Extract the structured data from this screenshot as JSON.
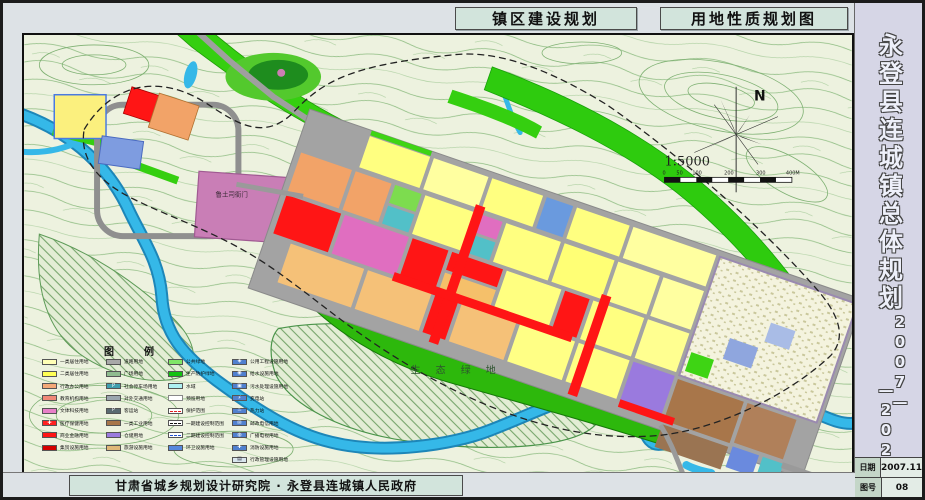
{
  "titles": {
    "left": "镇区建设规划",
    "right": "用地性质规划图"
  },
  "sidebar": {
    "title": "永登县连城镇总体规划",
    "years_top": "2007—",
    "years_bottom": "—2020",
    "table": [
      {
        "label": "日期",
        "value": "2007.11"
      },
      {
        "label": "图号",
        "value": "08"
      }
    ]
  },
  "footer": {
    "text": "甘肃省城乡规划设计研究院 · 永登县连城镇人民政府"
  },
  "map": {
    "labels": {
      "eco_green": "生 态 绿 地",
      "heritage": "鲁土司衙门"
    },
    "north_label": "N",
    "scale_text": "1:5000",
    "scale_ticks": [
      "0",
      "50",
      "100",
      "200",
      "300",
      "400M"
    ]
  },
  "legend": {
    "title": "图　例",
    "columns": [
      [
        {
          "label": "一类居住用地",
          "type": "solid",
          "color": "#ffffb6"
        },
        {
          "label": "二类居住用地",
          "type": "solid",
          "color": "#ffff55"
        },
        {
          "label": "行政办公用地",
          "type": "solid",
          "color": "#f4a978"
        },
        {
          "label": "教育机构用地",
          "type": "solid",
          "color": "#f08878"
        },
        {
          "label": "文体科技用地",
          "type": "solid",
          "color": "#e87fc8"
        },
        {
          "label": "医疗保健用地",
          "type": "cross",
          "color": "#ff2020"
        },
        {
          "label": "商业金融用地",
          "type": "solid",
          "color": "#ff1515"
        },
        {
          "label": "集贸设施用地",
          "type": "solid",
          "color": "#d40000"
        }
      ],
      [
        {
          "label": "道路用地",
          "type": "solid",
          "color": "#a8a8a8"
        },
        {
          "label": "广场用地",
          "type": "solid",
          "color": "#8fbc8f"
        },
        {
          "label": "社会停车场用地",
          "type": "p",
          "color": "#3f9fae"
        },
        {
          "label": "对外交通用地",
          "type": "solid",
          "color": "#9aa6ae"
        },
        {
          "label": "客运站",
          "type": "p",
          "color": "#5a6a72"
        },
        {
          "label": "一类工业用地",
          "type": "solid",
          "color": "#a8764a"
        },
        {
          "label": "仓储用地",
          "type": "solid",
          "color": "#9a7ade"
        },
        {
          "label": "旅游设施用地",
          "type": "solid",
          "color": "#e0b878"
        }
      ],
      [
        {
          "label": "公共绿地",
          "type": "solid",
          "color": "#7fe566"
        },
        {
          "label": "生产防护绿地",
          "type": "solid",
          "color": "#12c212"
        },
        {
          "label": "水域",
          "type": "solid",
          "color": "#aef0f2"
        },
        {
          "label": "预留用地",
          "type": "outline",
          "color": "#ffffff"
        },
        {
          "label": "保护范围",
          "type": "dashred",
          "color": "#ffffff"
        },
        {
          "label": "一期建设控制范围",
          "type": "dashdot",
          "color": "#ffffff"
        },
        {
          "label": "二期建设控制范围",
          "type": "dashblue",
          "color": "#ffffff"
        },
        {
          "label": "环卫设施用地",
          "type": "solid",
          "color": "#5588dd"
        }
      ],
      [
        {
          "label": "公用工程设施用地",
          "type": "glyph",
          "color": "#5080cf",
          "glyph": "◈"
        },
        {
          "label": "给水设施用地",
          "type": "glyph",
          "color": "#5080cf",
          "glyph": "◉"
        },
        {
          "label": "污水处理设施用地",
          "type": "glyph",
          "color": "#5080cf",
          "glyph": "▣"
        },
        {
          "label": "变电站",
          "type": "glyph",
          "color": "#5080cf",
          "glyph": "⚡"
        },
        {
          "label": "热力站",
          "type": "glyph",
          "color": "#5080cf",
          "glyph": "♨"
        },
        {
          "label": "邮政电信用地",
          "type": "glyph",
          "color": "#5080cf",
          "glyph": "✉"
        },
        {
          "label": "广播电视用地",
          "type": "glyph",
          "color": "#5080cf",
          "glyph": "◍"
        },
        {
          "label": "消防设施用地",
          "type": "glyph",
          "color": "#5080cf",
          "glyph": "✚"
        },
        {
          "label": "行政管理设施用地",
          "type": "glyph",
          "color": "#d9e6ee",
          "glyph": "▤",
          "glyph_color": "#334"
        }
      ]
    ]
  }
}
